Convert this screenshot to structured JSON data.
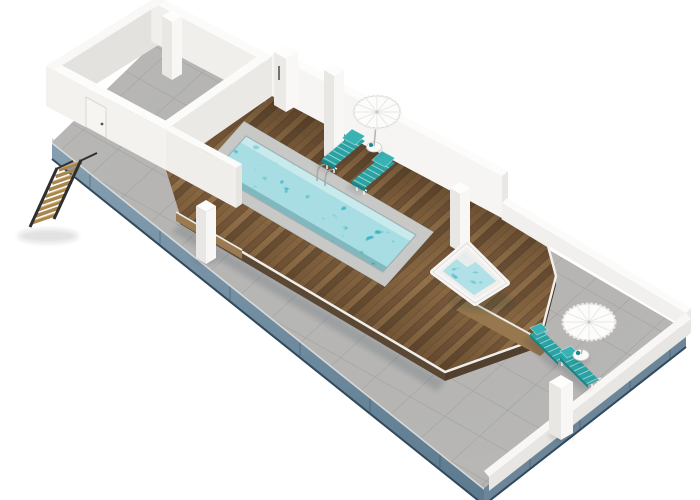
{
  "meta": {
    "title": "3D isometric rooftop terrace floor plan rendering",
    "view": "isometric-3d",
    "contains_text": false
  },
  "colors": {
    "background": "#ffffff",
    "pool_water": "#3eb5c2",
    "pool_coping": "#c8c9c6",
    "tile": "#b8b7b5",
    "tile_grout": "#9a9a98",
    "fascia_blue": "#7494a8",
    "fascia_blue_deep": "#5c7a8e",
    "wall_white": "#f4f3f1",
    "wall_shadow": "#e3e2df",
    "deck_wood": "#8a6843",
    "deck_wood_dark": "#5a4734",
    "lounger_teal": "#2aa2a3",
    "lounger_teal_dark": "#1d8486",
    "umbrella_white": "#fcfcfa",
    "stair_wood": "#a8854d",
    "stair_stringer": "#2f2f30",
    "frame_white": "#f4f4f2"
  },
  "scene": {
    "terrace": {
      "label": "rooftop terrace slab",
      "floor": "gray tile",
      "edge": "blue-gray glass fascia"
    },
    "room": {
      "label": "stair bulkhead room",
      "walls": "white",
      "floor": "gray tile",
      "doors": 2
    },
    "deck": {
      "label": "raised wooden pool deck",
      "material": "teak planks",
      "trim": "white"
    },
    "pool": {
      "label": "rectangular swimming pool",
      "water": "turquoise",
      "ladder": true
    },
    "hot_tub": {
      "label": "square hot tub",
      "rim": "white",
      "water": "turquoise"
    },
    "stairs": {
      "label": "wooden access stairs",
      "treads": 9
    },
    "pillars": {
      "count": 6,
      "color": "white"
    },
    "furniture": {
      "sun_loungers": {
        "count": 4,
        "color": "teal",
        "groups": [
          "pool deck pair",
          "lower terrace pair"
        ]
      },
      "parasols": {
        "count": 2,
        "color": "white"
      },
      "side_tables": {
        "count": 2,
        "color": "white"
      }
    },
    "perimeter": {
      "tall_wall": "white, along upper-right edge",
      "parapet": "low white wall along right edges"
    }
  }
}
